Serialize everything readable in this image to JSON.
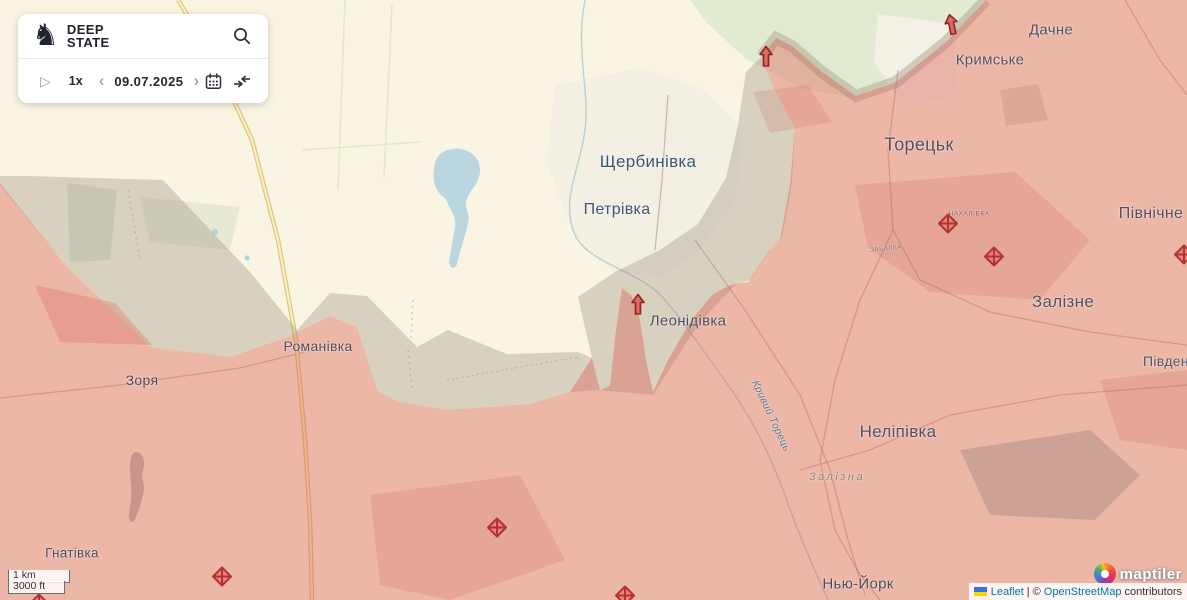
{
  "panel": {
    "brand": {
      "line1": "DEEP",
      "line2": "STATE"
    },
    "icons": {
      "knight": "♞",
      "play": "▷",
      "prev": "‹",
      "next": "›"
    },
    "speed": "1x",
    "date": "09.07.2025"
  },
  "scalebar": {
    "metric": "1 km",
    "imperial": "3000 ft"
  },
  "attribution": {
    "leaflet_label": "Leaflet",
    "divider": "|",
    "copyright": "©",
    "osm_label": "OpenStreetMap",
    "suffix": "contributors"
  },
  "maptiler": {
    "text": "maptiler"
  },
  "map": {
    "labels": [
      {
        "text": "Щербинівка",
        "x": 648,
        "y": 162,
        "size": 17,
        "color": "#3d5673"
      },
      {
        "text": "Петрівка",
        "x": 617,
        "y": 210,
        "size": 16,
        "color": "#3d5673"
      },
      {
        "text": "Дачне",
        "x": 1051,
        "y": 30,
        "size": 15,
        "color": "#544e5e"
      },
      {
        "text": "Кримське",
        "x": 990,
        "y": 60,
        "size": 15,
        "color": "#544e5e"
      },
      {
        "text": "Торецьк",
        "x": 919,
        "y": 145,
        "size": 18,
        "color": "#544e5e"
      },
      {
        "text": "Північне",
        "x": 1151,
        "y": 214,
        "size": 16,
        "color": "#544e5e"
      },
      {
        "text": "Залізне",
        "x": 1063,
        "y": 302,
        "size": 17,
        "color": "#544e5e"
      },
      {
        "text": "Південне",
        "x": 1174,
        "y": 361,
        "size": 14,
        "color": "#544e5e"
      },
      {
        "text": "Неліпівка",
        "x": 898,
        "y": 432,
        "size": 17,
        "color": "#544e5e"
      },
      {
        "text": "Нью-Йорк",
        "x": 858,
        "y": 584,
        "size": 15,
        "color": "#504a55"
      },
      {
        "text": "Зоря",
        "x": 142,
        "y": 380,
        "size": 14,
        "color": "#504a55"
      },
      {
        "text": "Романівка",
        "x": 318,
        "y": 346,
        "size": 14,
        "color": "#504a55"
      },
      {
        "text": "Гнатівка",
        "x": 72,
        "y": 553,
        "size": 13.5,
        "color": "#504a55"
      },
      {
        "text": "Леонідівка",
        "x": 688,
        "y": 321,
        "size": 15,
        "color": "#4f4a58"
      },
      {
        "text": "НАХАЛІВКА",
        "x": 969,
        "y": 214,
        "size": 6.5,
        "color": "#8a4f58",
        "ls": 0.5
      },
      {
        "text": "ЗАБАЛКА",
        "x": 886,
        "y": 249,
        "size": 6.5,
        "color": "#7e6b60",
        "rotate": -6
      },
      {
        "text": "Залізна",
        "x": 837,
        "y": 477,
        "size": 11,
        "color": "#8b7d71",
        "italic": true,
        "ls": 2.5
      },
      {
        "text": "Кривий Торець",
        "x": 771,
        "y": 416,
        "size": 10.5,
        "color": "#5e7186",
        "italic": true,
        "rotate": 65
      }
    ],
    "markers": [
      {
        "type": "diamond",
        "x": 948,
        "y": 226
      },
      {
        "type": "diamond",
        "x": 994,
        "y": 259
      },
      {
        "type": "diamond",
        "x": 1184,
        "y": 257
      },
      {
        "type": "diamond",
        "x": 222,
        "y": 579
      },
      {
        "type": "diamond",
        "x": 497,
        "y": 530
      },
      {
        "type": "diamond",
        "x": 625,
        "y": 598
      },
      {
        "type": "diamond",
        "x": 39,
        "y": 606
      },
      {
        "type": "arrow",
        "x": 638,
        "y": 307,
        "rotate": 0
      },
      {
        "type": "arrow",
        "x": 766,
        "y": 59,
        "rotate": 0
      },
      {
        "type": "arrow",
        "x": 952,
        "y": 27,
        "rotate": -12
      }
    ],
    "zone_colors": {
      "occupied": "rgba(219,98,87,0.42)",
      "gray_zone": "rgba(156,144,128,0.35)",
      "base": "#faf4e2"
    }
  }
}
